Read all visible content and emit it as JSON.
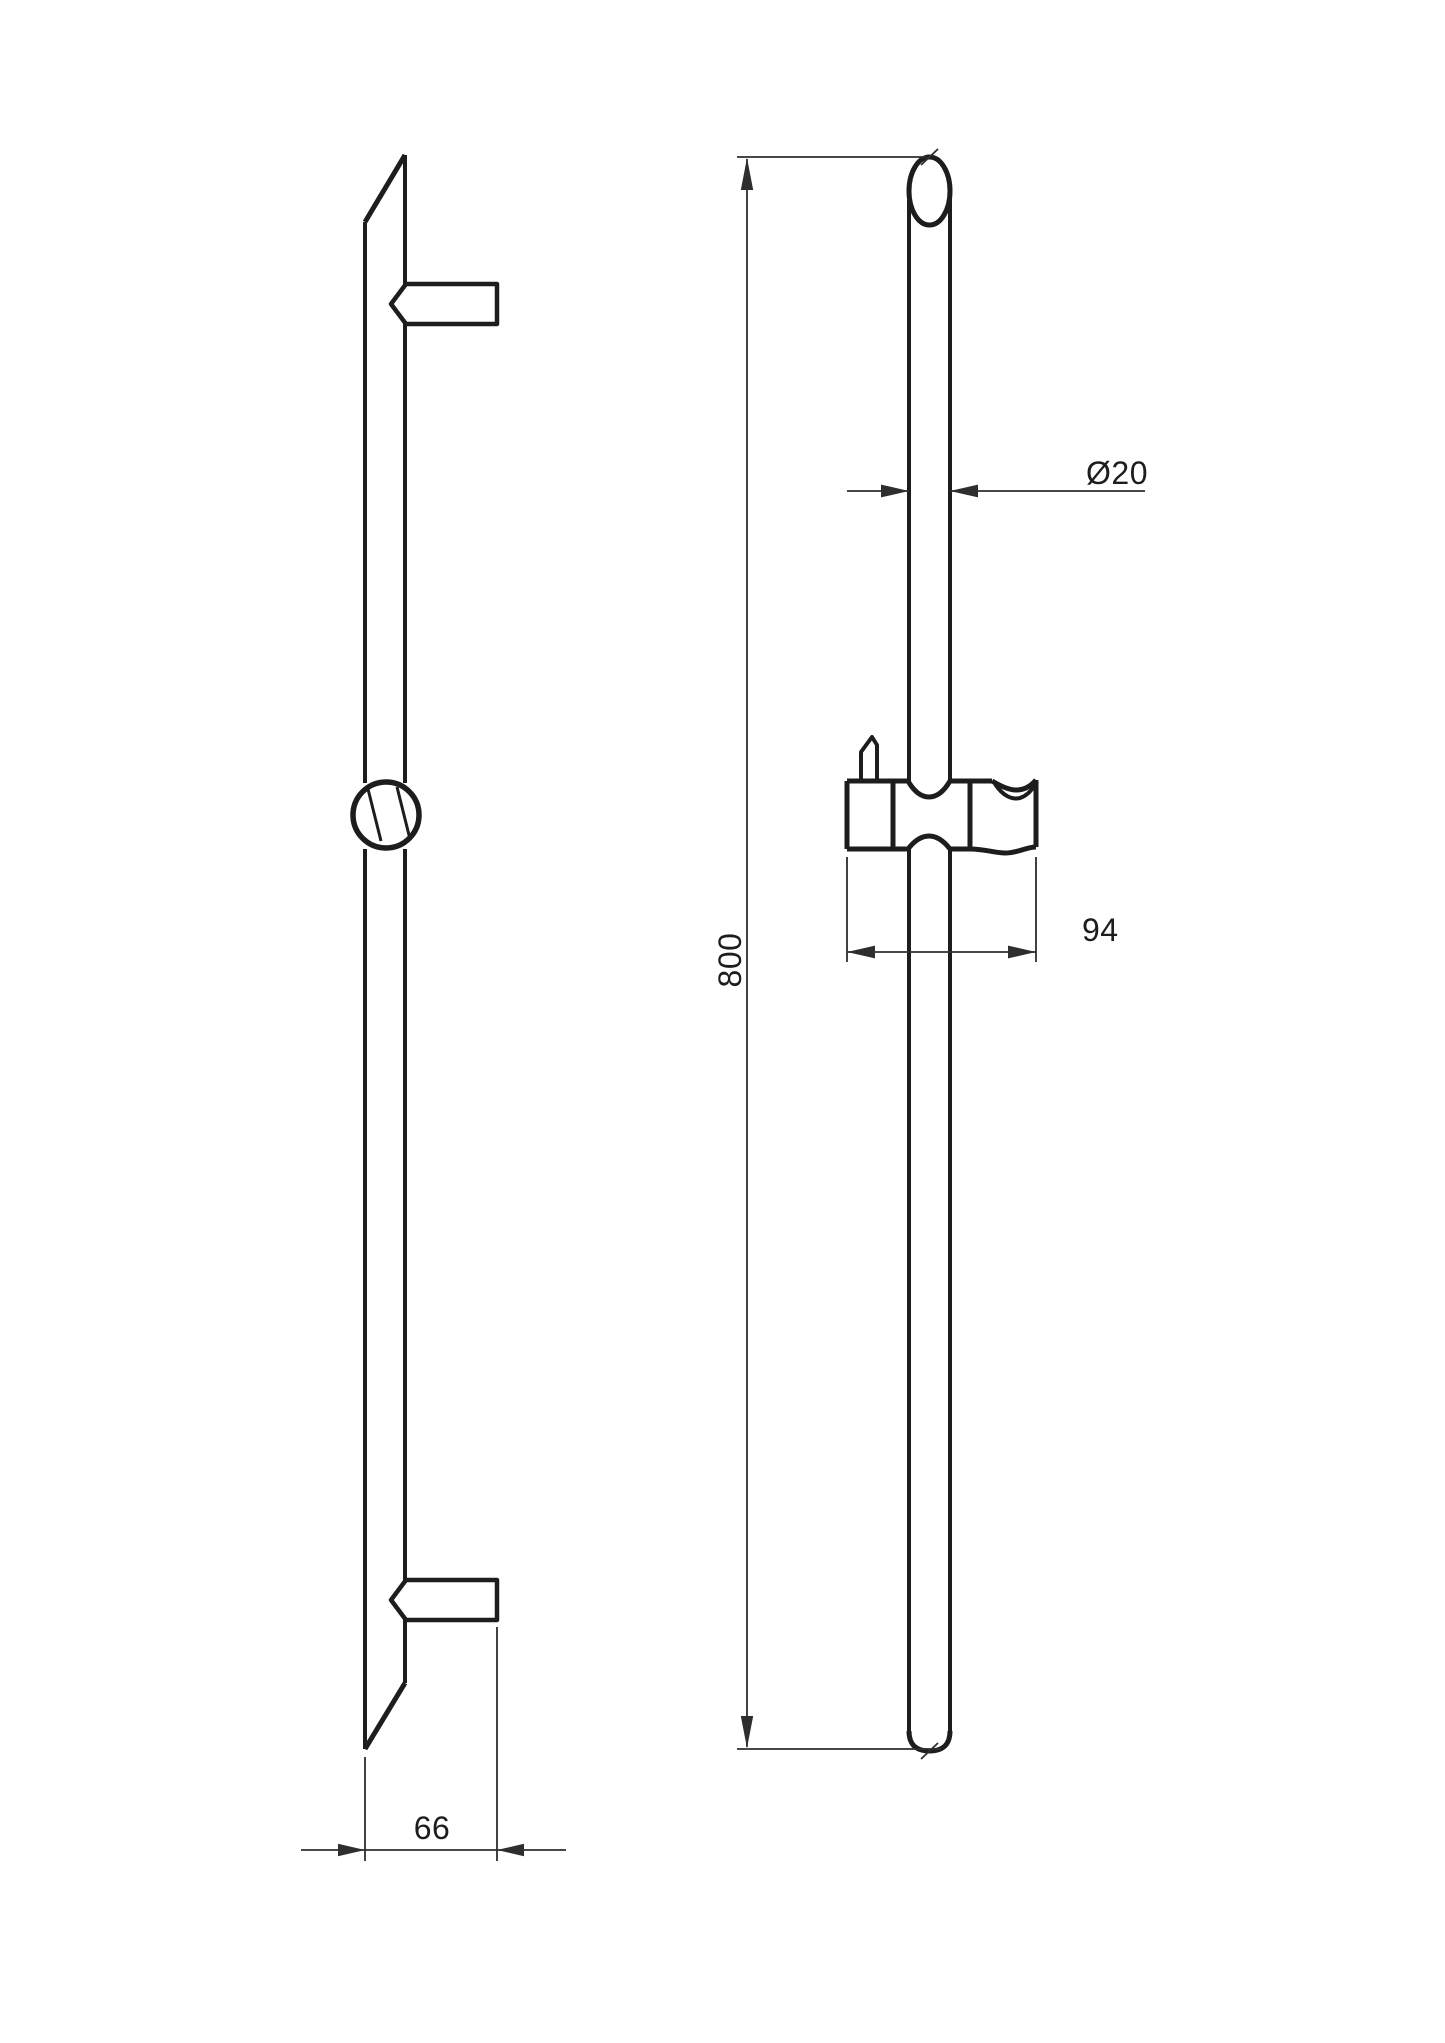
{
  "sheet": {
    "background": "#ffffff",
    "object_line_color": "#1d1d1b",
    "dimension_line_color": "#2e2e2d",
    "text_color": "#1d1d1b"
  },
  "dimensions": {
    "overall_height": "800",
    "bar_diameter": "Ø20",
    "holder_width": "94",
    "bracket_depth": "66"
  }
}
